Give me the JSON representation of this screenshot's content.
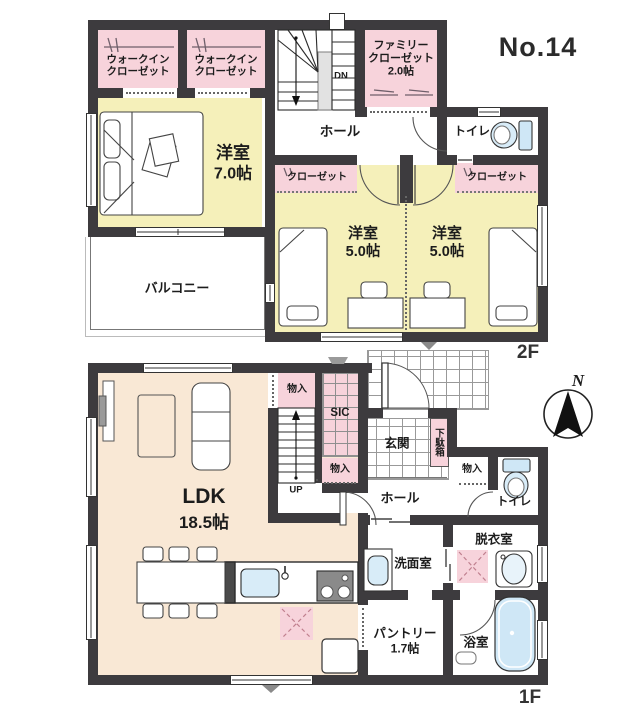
{
  "header": {
    "plan_no": "No.14"
  },
  "floor2": {
    "label": "2F",
    "walk_in_closet_1": {
      "line1": "ウォークイン",
      "line2": "クローゼット"
    },
    "walk_in_closet_2": {
      "line1": "ウォークイン",
      "line2": "クローゼット"
    },
    "family_closet": {
      "line1": "ファミリー",
      "line2": "クローゼット",
      "size": "2.0帖"
    },
    "stairs_down": "DN",
    "hall": "ホール",
    "toilet": "トイレ",
    "bedroom_main": {
      "name": "洋室",
      "size": "7.0帖"
    },
    "closet_left": "クローゼット",
    "closet_right": "クローゼット",
    "bedroom_left": {
      "name": "洋室",
      "size": "5.0帖"
    },
    "bedroom_right": {
      "name": "洋室",
      "size": "5.0帖"
    },
    "balcony": "バルコニー"
  },
  "floor1": {
    "label": "1F",
    "ldk": {
      "name": "LDK",
      "size": "18.5帖"
    },
    "storage_top": "物入",
    "shoe_in_closet": "SIC",
    "storage_mid": "物入",
    "storage_hall": "物入",
    "stairs_up": "UP",
    "entrance": "玄関",
    "shoe_cabinet": "下駄箱",
    "hall": "ホール",
    "toilet": "トイレ",
    "washroom": "洗面室",
    "dressing_room": "脱衣室",
    "pantry": {
      "name": "パントリー",
      "size": "1.7帖"
    },
    "bathroom": "浴室"
  },
  "compass": {
    "north_label": "N"
  },
  "colors": {
    "wall": "#3d3b3e",
    "room_yellow": "#f5f0ba",
    "room_pink": "#f7d3db",
    "room_cream": "#f9e8d5",
    "fixture_blue": "#cfe7f6"
  }
}
